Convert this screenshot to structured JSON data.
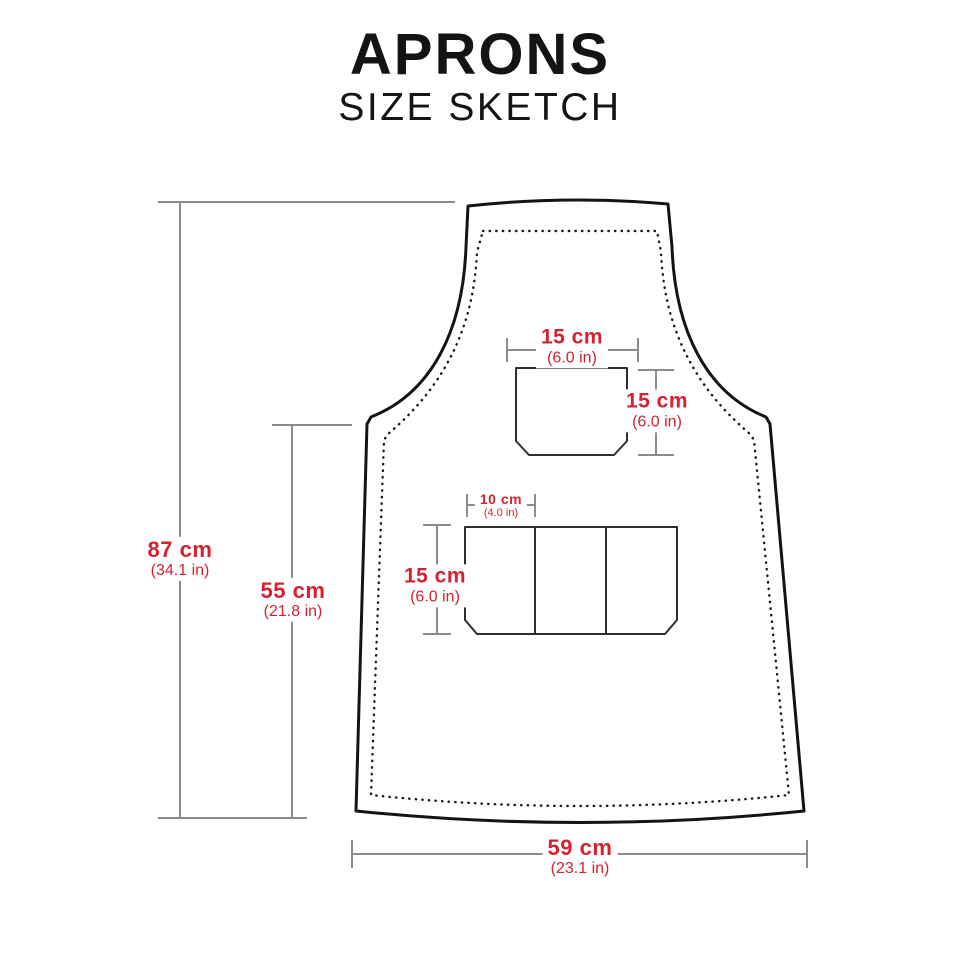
{
  "header": {
    "title": "APRONS",
    "subtitle": "SIZE SKETCH"
  },
  "colors": {
    "accent_red": "#d42230",
    "outline_black": "#141414",
    "pocket_line": "#2e2e2e",
    "dim_line_gray": "#8c8c8c",
    "background": "#ffffff"
  },
  "measurements": {
    "total_height": {
      "value": "87 cm",
      "alt": "(34.1 in)"
    },
    "waist_height": {
      "value": "55 cm",
      "alt": "(21.8 in)"
    },
    "chest_pocket_width": {
      "value": "15 cm",
      "alt": "(6.0 in)"
    },
    "chest_pocket_height": {
      "value": "15 cm",
      "alt": "(6.0 in)"
    },
    "waist_pocket_section_width": {
      "value": "10 cm",
      "alt": "(4.0 in)"
    },
    "waist_pocket_height": {
      "value": "15 cm",
      "alt": "(6.0 in)"
    },
    "bottom_width": {
      "value": "59 cm",
      "alt": "(23.1 in)"
    }
  }
}
